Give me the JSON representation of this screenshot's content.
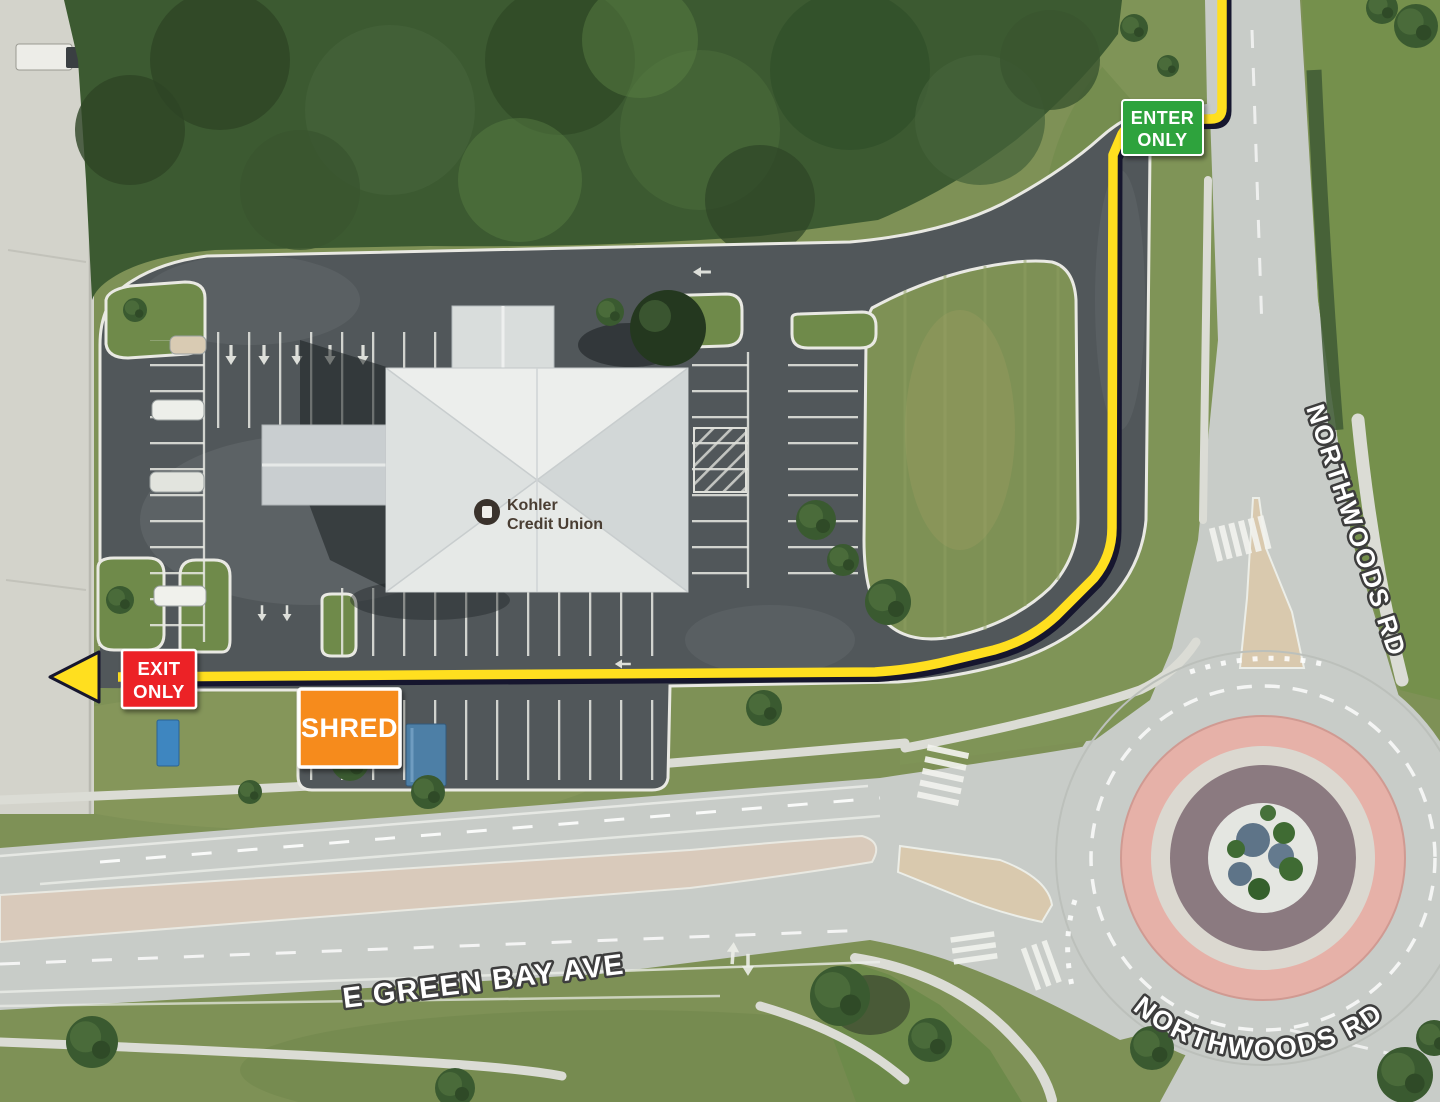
{
  "signs": {
    "enter": {
      "line1": "ENTER",
      "line2": "ONLY",
      "color": "#2ea33c"
    },
    "exit": {
      "line1": "EXIT",
      "line2": "ONLY",
      "color": "#ec2127"
    },
    "shred": {
      "label": "SHRED",
      "color": "#f68b1e"
    }
  },
  "route": {
    "color": "#ffdf1f",
    "outline": "#16162e"
  },
  "roads": {
    "northwoods_upper": "NORTHWOODS RD",
    "northwoods_lower": "NORTHWOODS RD",
    "e_green_bay": "E GREEN BAY AVE"
  },
  "building": {
    "line1": "Kohler",
    "line2": "Credit Union"
  }
}
